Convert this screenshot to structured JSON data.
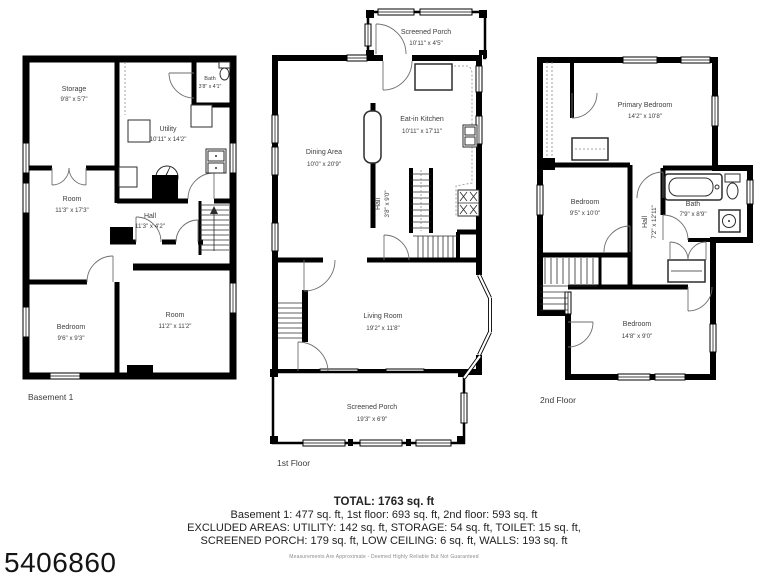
{
  "colors": {
    "wall": "#000000",
    "room_text": "#3d3d3d",
    "disclaimer_text": "#8a8a8a"
  },
  "mls_number": "5406860",
  "floors": {
    "basement": {
      "label": "Basement 1",
      "rooms": {
        "storage": {
          "name": "Storage",
          "dims": "9'8\" x 5'7\""
        },
        "bath": {
          "name": "Bath",
          "dims": "3'8\" x 4'1\""
        },
        "utility": {
          "name": "Utility",
          "dims": "10'11\" x 14'2\""
        },
        "room1": {
          "name": "Room",
          "dims": "11'3\" x 17'3\""
        },
        "hall": {
          "name": "Hall",
          "dims": "11'3\" x 4'2\""
        },
        "bedroom": {
          "name": "Bedroom",
          "dims": "9'6\" x 9'3\""
        },
        "room2": {
          "name": "Room",
          "dims": "11'2\" x 11'2\""
        }
      }
    },
    "first": {
      "label": "1st Floor",
      "rooms": {
        "porch_top": {
          "name": "Screened Porch",
          "dims": "10'11\" x 4'5\""
        },
        "kitchen": {
          "name": "Eat-in Kitchen",
          "dims": "10'11\" x 17'11\""
        },
        "dining": {
          "name": "Dining Area",
          "dims": "10'0\" x 20'9\""
        },
        "hall": {
          "name": "Hall",
          "dims": "3'8\" x 9'0\""
        },
        "living": {
          "name": "Living Room",
          "dims": "19'2\" x 11'8\""
        },
        "porch_bottom": {
          "name": "Screened Porch",
          "dims": "19'3\" x 6'9\""
        }
      }
    },
    "second": {
      "label": "2nd Floor",
      "rooms": {
        "primary": {
          "name": "Primary Bedroom",
          "dims": "14'2\" x 10'8\""
        },
        "bedroom1": {
          "name": "Bedroom",
          "dims": "9'5\" x 10'0\""
        },
        "hall": {
          "name": "Hall",
          "dims": "7'2\" x 12'11\""
        },
        "bath": {
          "name": "Bath",
          "dims": "7'9\" x 8'9\""
        },
        "bedroom2": {
          "name": "Bedroom",
          "dims": "14'8\" x 9'0\""
        }
      }
    }
  },
  "footer": {
    "total": "TOTAL: 1763 sq. ft",
    "line1": "Basement 1: 477 sq. ft, 1st floor: 693 sq. ft, 2nd floor: 593 sq. ft",
    "line2": "EXCLUDED AREAS: UTILITY: 142 sq. ft, STORAGE: 54 sq. ft, TOILET: 15 sq. ft,",
    "line3": "SCREENED PORCH: 179 sq. ft, LOW CEILING: 6 sq. ft, WALLS: 193 sq. ft",
    "disclaimer": "Measurements Are Approximate - Deemed Highly Reliable But Not Guaranteed"
  }
}
